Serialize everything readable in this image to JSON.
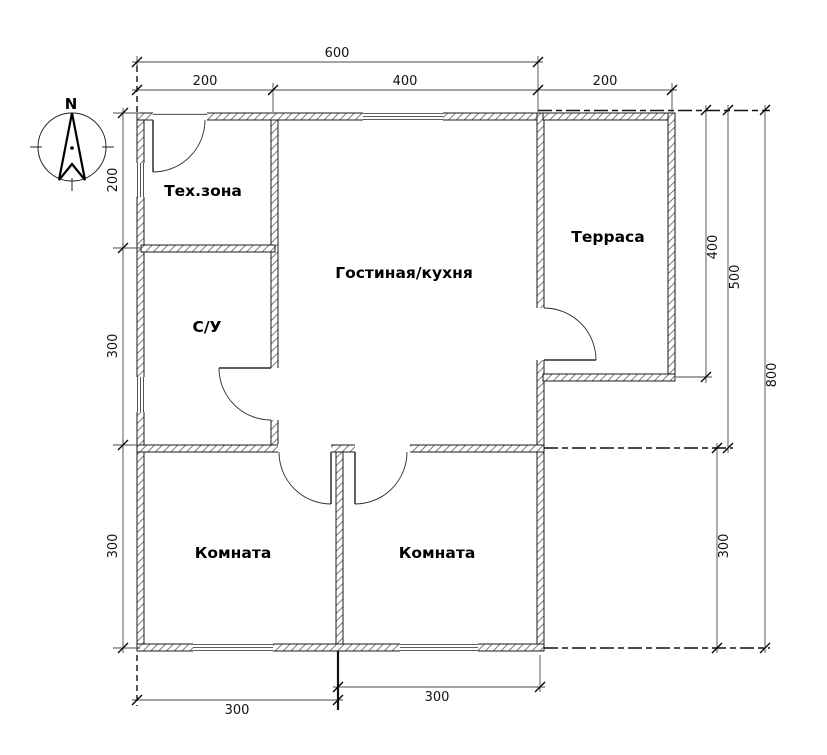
{
  "drawing": {
    "compass": {
      "north_label": "N"
    },
    "rooms": {
      "tech": {
        "label": "Тех.зона"
      },
      "bathroom": {
        "label": "С/У"
      },
      "living": {
        "label": "Гостиная/кухня"
      },
      "terrace": {
        "label": "Терраса"
      },
      "bedroom_left": {
        "label": "Комната"
      },
      "bedroom_right": {
        "label": "Комната"
      }
    },
    "dimensions": {
      "top_total": "600",
      "top_left": "200",
      "top_middle": "400",
      "top_terrace": "200",
      "left_tech": "200",
      "left_bathroom": "300",
      "left_bedroom": "300",
      "right_terrace": "400",
      "right_upper": "500",
      "right_total": "800",
      "right_bedroom": "300",
      "bottom_left": "300",
      "bottom_right": "300"
    },
    "colors": {
      "line": "#1a1a1a",
      "dim_line": "#4a4a4a",
      "background": "#ffffff"
    }
  }
}
